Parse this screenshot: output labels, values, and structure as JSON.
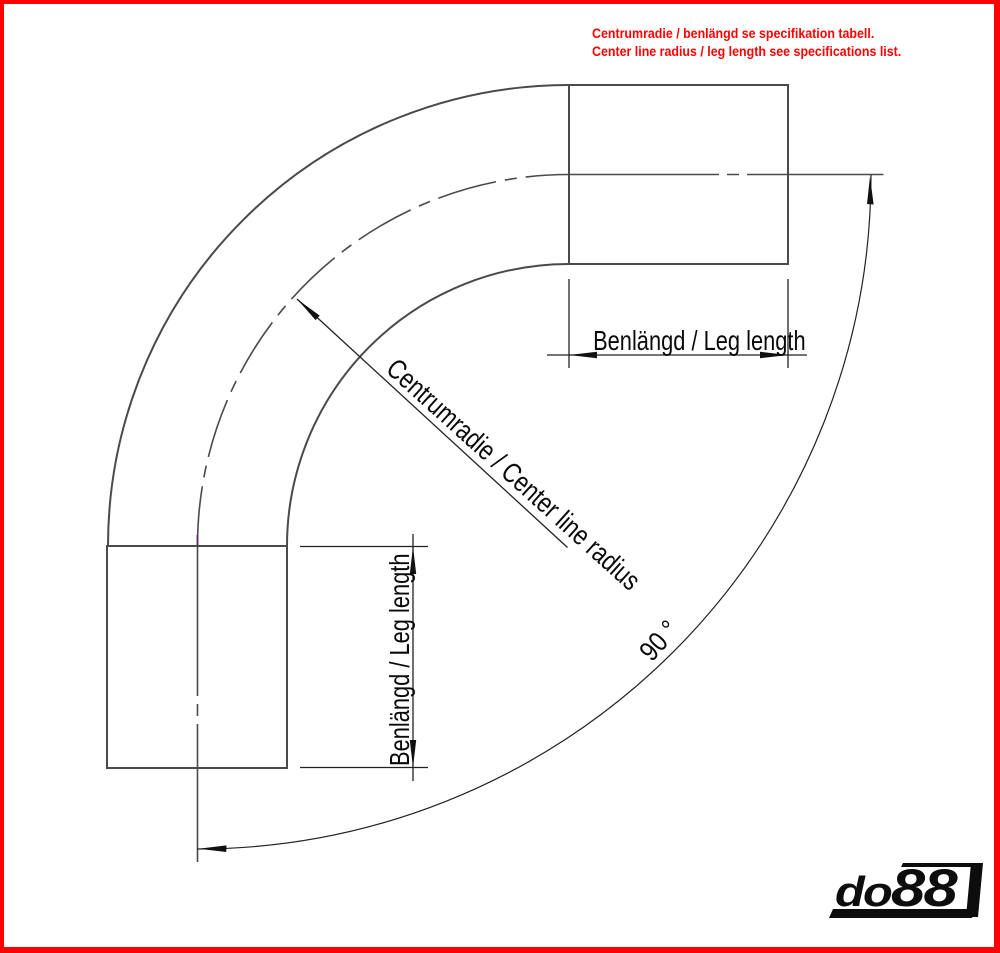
{
  "notice": {
    "line1": "Centrumradie / benlängd se specifikation tabell.",
    "line2": "Center line radius / leg length see specifications list."
  },
  "dimensions": {
    "top_leg_label": "Benlängd / Leg length",
    "left_leg_label": "Benlängd / Leg length",
    "radius_label": "Centrumradie / Center line radius",
    "angle_label": "90 °"
  },
  "logo": {
    "part1": "do",
    "part2": "88"
  },
  "colors": {
    "frame_red": "#ff0000",
    "notice_red": "#ff0000",
    "pipe_outline_gray": "#4a4a4a",
    "dimension_black": "#222222",
    "centerline_tick_purple": "#5f2a68",
    "logo_black": "#0d0d0d"
  }
}
